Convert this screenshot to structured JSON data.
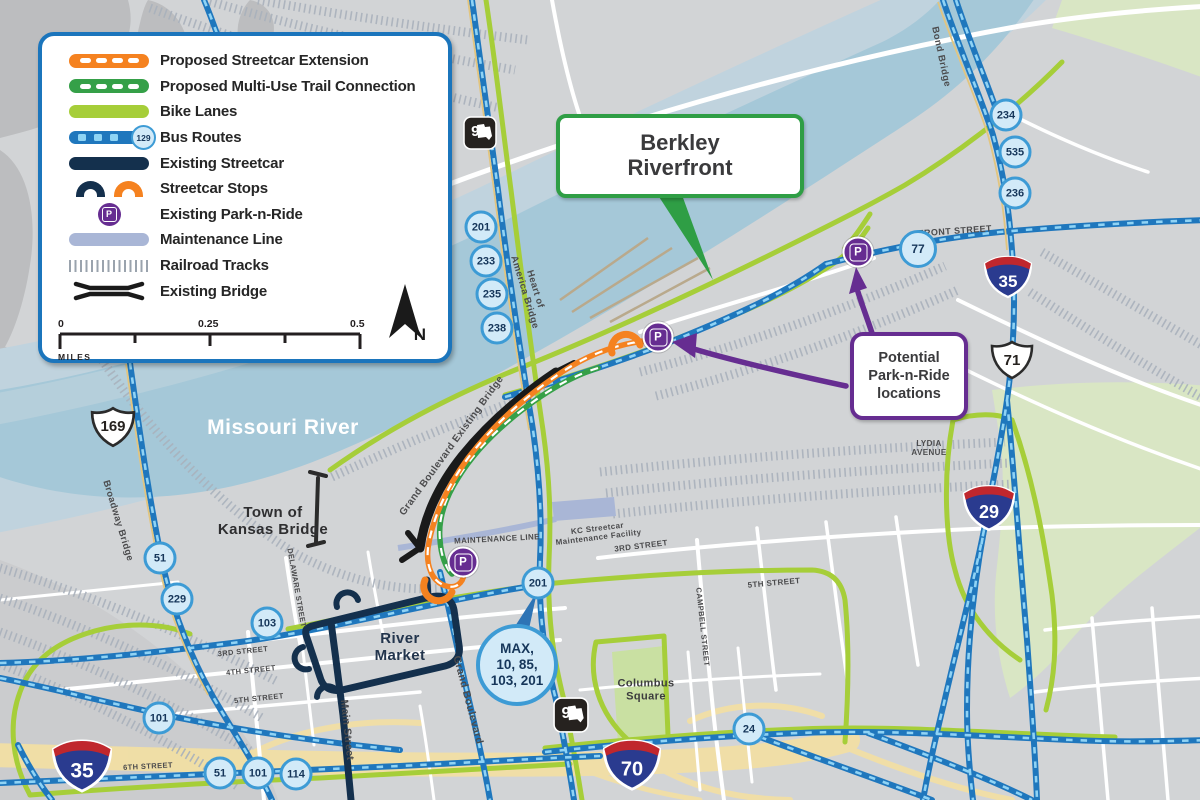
{
  "legend": {
    "items": [
      {
        "id": "proposed-streetcar",
        "label": "Proposed Streetcar Extension"
      },
      {
        "id": "proposed-trail",
        "label": "Proposed Multi-Use Trail Connection"
      },
      {
        "id": "bike-lanes",
        "label": "Bike Lanes"
      },
      {
        "id": "bus-routes",
        "label": "Bus Routes",
        "badge": "129"
      },
      {
        "id": "existing-streetcar",
        "label": "Existing Streetcar"
      },
      {
        "id": "streetcar-stops",
        "label": "Streetcar Stops"
      },
      {
        "id": "park-n-ride",
        "label": "Existing Park-n-Ride",
        "glyph": "P"
      },
      {
        "id": "maintenance-line",
        "label": "Maintenance Line"
      },
      {
        "id": "railroad-tracks",
        "label": "Railroad Tracks"
      },
      {
        "id": "existing-bridge",
        "label": "Existing Bridge"
      }
    ],
    "scale": {
      "start": "0",
      "mid": "0.25",
      "end": "0.5",
      "unit": "MILES"
    },
    "north_label": "N"
  },
  "callouts": {
    "berkley": {
      "line1": "Berkley",
      "line2": "Riverfront"
    },
    "park_n_ride": {
      "line1": "Potential",
      "line2": "Park-n-Ride",
      "line3": "locations"
    }
  },
  "map_labels": {
    "missouri_river": "Missouri River",
    "town_of_kansas": {
      "line1": "Town of",
      "line2": "Kansas Bridge"
    },
    "river_market": {
      "line1": "River",
      "line2": "Market"
    },
    "columbus_square": {
      "line1": "Columbus",
      "line2": "Square"
    },
    "lydia_avenue": {
      "line1": "LYDIA",
      "line2": "AVENUE"
    },
    "kc_facility": {
      "line1": "KC Streetcar",
      "line2": "Maintenance Facility"
    },
    "heart_of_america": {
      "line1": "Heart of",
      "line2": "America Bridge"
    },
    "front_street": "FRONT STREET",
    "bond_bridge": "Bond Bridge",
    "broadway_bridge": "Broadway Bridge",
    "grand_bridge": "Grand Boulevard Existing Bridge",
    "delaware_street": "DELAWARE STREET",
    "main_street": "Main Street",
    "grand_boulevard": "Grand Boulevard",
    "maintenance_line": "MAINTENANCE LINE",
    "campbell_street": "CAMPBELL STREET",
    "third_street_e": "3RD STREET",
    "fifth_street_e": "5TH STREET",
    "third_street_w": "3RD STREET",
    "fourth_street_w": "4TH STREET",
    "fifth_street_w": "5TH STREET",
    "sixth_street_w": "6TH STREET"
  },
  "shields": {
    "i35": "35",
    "i29": "29",
    "i70": "70",
    "us169": "169",
    "us71": "71",
    "mo9": "9"
  },
  "badges": [
    {
      "label": "201",
      "x": 481,
      "y": 227
    },
    {
      "label": "233",
      "x": 486,
      "y": 261
    },
    {
      "label": "235",
      "x": 492,
      "y": 294
    },
    {
      "label": "238",
      "x": 497,
      "y": 328
    },
    {
      "label": "234",
      "x": 1006,
      "y": 115
    },
    {
      "label": "535",
      "x": 1015,
      "y": 152
    },
    {
      "label": "236",
      "x": 1015,
      "y": 193
    },
    {
      "label": "77",
      "x": 918,
      "y": 249,
      "r": 19
    },
    {
      "label": "51",
      "x": 160,
      "y": 558
    },
    {
      "label": "229",
      "x": 177,
      "y": 599
    },
    {
      "label": "103",
      "x": 267,
      "y": 623
    },
    {
      "label": "201",
      "x": 538,
      "y": 583
    },
    {
      "label": "101",
      "x": 159,
      "y": 718
    },
    {
      "label": "51",
      "x": 220,
      "y": 773
    },
    {
      "label": "101",
      "x": 258,
      "y": 773
    },
    {
      "label": "114",
      "x": 296,
      "y": 774
    },
    {
      "label": "24",
      "x": 749,
      "y": 729
    }
  ],
  "max_badge": {
    "lines": [
      "MAX,",
      "10, 85,",
      "103, 201"
    ]
  },
  "p_marker_glyph": "P",
  "colors": {
    "streetcar_extension": "#f58220",
    "trail": "#35a048",
    "bike_lanes": "#a6ce39",
    "bus_route": "#1f77bd",
    "existing_streetcar": "#14304d",
    "park_n_ride": "#662d91",
    "maintenance": "#a9b6d6",
    "river": "#a5c8d8",
    "legend_border": "#1b75bc",
    "callout_green": "#2f9e45"
  }
}
